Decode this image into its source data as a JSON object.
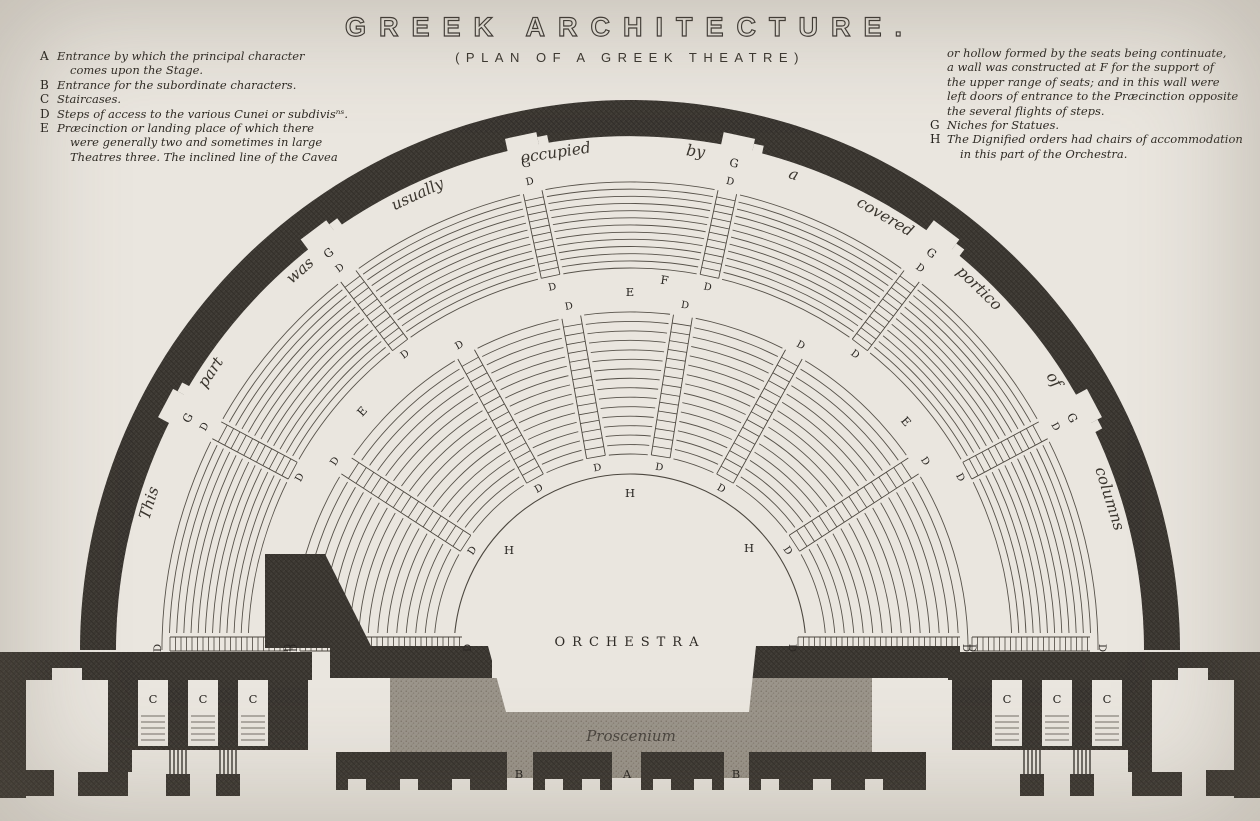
{
  "title": "GREEK ARCHITECTURE.",
  "subtitle": "(PLAN OF A GREEK THEATRE)",
  "legend_left": [
    {
      "key": "A",
      "lines": [
        "Entrance by which the principal character",
        "comes upon the Stage."
      ]
    },
    {
      "key": "B",
      "lines": [
        "Entrance for the subordinate characters."
      ]
    },
    {
      "key": "C",
      "lines": [
        "Staircases."
      ]
    },
    {
      "key": "D",
      "lines": [
        "Steps of access to the various Cunei or subdivisⁿˢ."
      ]
    },
    {
      "key": "E",
      "lines": [
        "Præcinction or landing place of which there",
        "were generally two and sometimes in large",
        "Theatres three. The inclined line of the Cavea"
      ]
    }
  ],
  "legend_right": [
    {
      "key": "",
      "lines": [
        "or hollow formed by the seats being continuate,",
        "a wall was constructed at F for the support of",
        "the upper range of seats; and in this wall were",
        "left doors of entrance to the Præcinction opposite",
        "the several flights of steps."
      ]
    },
    {
      "key": "G",
      "lines": [
        "Niches for Statues."
      ]
    },
    {
      "key": "H",
      "lines": [
        "The Dignified orders had chairs of accommodation",
        "in this part of the Orchestra."
      ]
    }
  ],
  "plan": {
    "curved_caption": {
      "sentence": "This part was usually occupied by a covered portico of columns",
      "words": [
        {
          "t": "This",
          "a": 163
        },
        {
          "t": "part",
          "a": 146.5
        },
        {
          "t": "was",
          "a": 131
        },
        {
          "t": "usually",
          "a": 115
        },
        {
          "t": "occupied",
          "a": 98.5
        },
        {
          "t": "by",
          "a": 82.5
        },
        {
          "t": "a",
          "a": 71
        },
        {
          "t": "covered",
          "a": 59.5
        },
        {
          "t": "portico",
          "a": 46
        },
        {
          "t": "of",
          "a": 32.5
        },
        {
          "t": "columns",
          "a": 17.5
        }
      ]
    },
    "orchestra_label": "ORCHESTRA",
    "proscenium_label": "Proscenium",
    "stair_label": "D",
    "niche_label": "G",
    "niche_angles": [
      152,
      127,
      102,
      78,
      53,
      28
    ],
    "upper_stair_angles": [
      152,
      127,
      102,
      78,
      53,
      28
    ],
    "lower_stair_angles": [
      147,
      119,
      100,
      81,
      61,
      33
    ],
    "markers": [
      {
        "t": "E",
        "x": 365,
        "y": 411,
        "rot": -48
      },
      {
        "t": "E",
        "x": 630,
        "y": 293,
        "rot": 0
      },
      {
        "t": "E",
        "x": 903,
        "y": 421,
        "rot": 49
      },
      {
        "t": "F",
        "x": 664,
        "y": 281,
        "rot": 8
      },
      {
        "t": "H",
        "x": 509,
        "y": 551,
        "rot": 0
      },
      {
        "t": "H",
        "x": 630,
        "y": 494,
        "rot": 0
      },
      {
        "t": "H",
        "x": 749,
        "y": 549,
        "rot": 0
      },
      {
        "t": "C",
        "x": 153,
        "y": 700,
        "rot": 0
      },
      {
        "t": "C",
        "x": 203,
        "y": 700,
        "rot": 0
      },
      {
        "t": "C",
        "x": 253,
        "y": 700,
        "rot": 0
      },
      {
        "t": "C",
        "x": 1007,
        "y": 700,
        "rot": 0
      },
      {
        "t": "C",
        "x": 1057,
        "y": 700,
        "rot": 0
      },
      {
        "t": "C",
        "x": 1107,
        "y": 700,
        "rot": 0
      },
      {
        "t": "B",
        "x": 519,
        "y": 775,
        "rot": 0
      },
      {
        "t": "A",
        "x": 627,
        "y": 775,
        "rot": 0
      },
      {
        "t": "B",
        "x": 736,
        "y": 775,
        "rot": 0
      }
    ],
    "colors": {
      "paper": "#eae6df",
      "ink": "#39352f",
      "seat_line": "#57524a",
      "stone_gray": "#9b958b"
    }
  }
}
